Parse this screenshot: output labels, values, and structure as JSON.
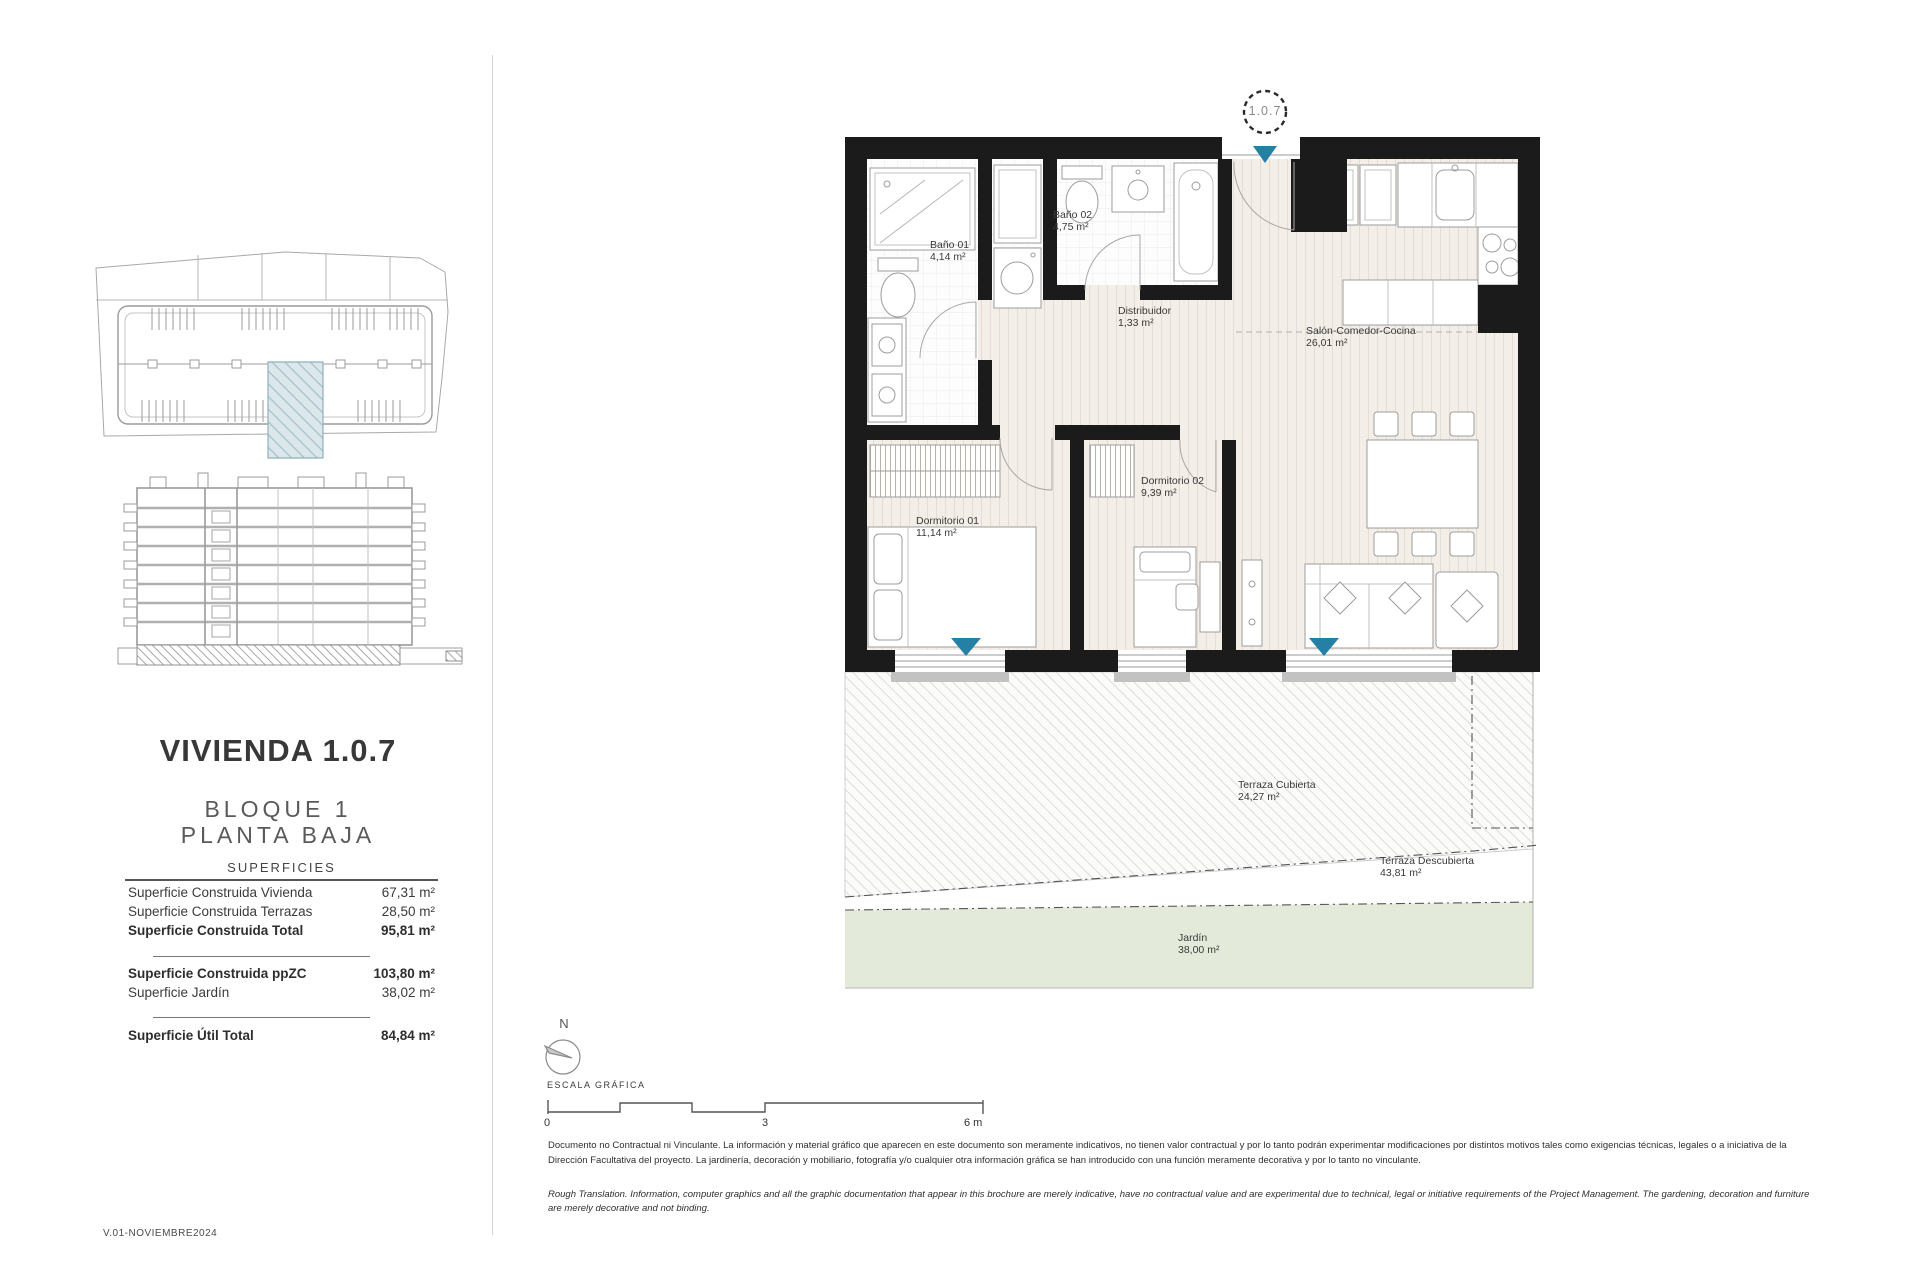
{
  "page": {
    "version": "V.01-NOVIEMBRE2024"
  },
  "left_panel": {
    "title": "VIVIENDA 1.0.7",
    "block_line": "BLOQUE 1",
    "floor_line": "PLANTA BAJA",
    "surfaces": {
      "header": "SUPERFICIES",
      "rows_a": [
        {
          "label": "Superficie Construida Vivienda",
          "value": "67,31 m²"
        },
        {
          "label": "Superficie Construida Terrazas",
          "value": "28,50 m²"
        },
        {
          "label": "Superficie Construida Total",
          "value": "95,81 m²"
        }
      ],
      "rows_b": [
        {
          "label": "Superficie Construida ppZC",
          "value": "103,80 m²"
        },
        {
          "label": "Superficie Jardín",
          "value": "38,02 m²"
        }
      ],
      "rows_c": [
        {
          "label": "Superficie Útil Total",
          "value": "84,84 m²"
        }
      ]
    }
  },
  "plan": {
    "unit_marker": "1.0.7",
    "rooms": [
      {
        "name": "Baño 01",
        "area": "4,14 m²"
      },
      {
        "name": "Baño 02",
        "area": "4,75 m²"
      },
      {
        "name": "Distribuidor",
        "area": "1,33 m²"
      },
      {
        "name": "Salón-Comedor-Cocina",
        "area": "26,01 m²"
      },
      {
        "name": "Dormitorio 01",
        "area": "11,14 m²"
      },
      {
        "name": "Dormitorio 02",
        "area": "9,39 m²"
      },
      {
        "name": "Terraza Cubierta",
        "area": "24,27 m²"
      },
      {
        "name": "Terraza Descubierta",
        "area": "43,81 m²"
      },
      {
        "name": "Jardín",
        "area": "38,00 m²"
      }
    ]
  },
  "scale_bar": {
    "north": "N",
    "caption": "ESCALA GRÁFICA",
    "tick0": "0",
    "tick1": "3",
    "tick2": "6 m"
  },
  "disclaimer": {
    "spanish": "Documento no Contractual ni Vinculante. La información y material gráfico que aparecen en este documento son meramente indicativos, no tienen valor contractual y por lo tanto podrán experimentar modificaciones por distintos motivos tales como exigencias técnicas, legales o a iniciativa de la Dirección Facultativa del proyecto. La jardinería, decoración y mobiliario, fotografía y/o cualquier otra información gráfica se han introducido con una función meramente decorativa y por lo tanto no vinculante.",
    "english": "Rough Translation. Information, computer graphics and all the graphic documentation that appear in this brochure are merely indicative, have no contractual value and are experimental due to technical, legal or initiative requirements of the Project Management. The gardening, decoration and furniture are merely decorative and not binding."
  },
  "colors": {
    "accent_teal": "#2680a5",
    "wall_black": "#1b1b1b",
    "floor_beige": "#f3eee7",
    "garden_green": "#e3ead9"
  }
}
